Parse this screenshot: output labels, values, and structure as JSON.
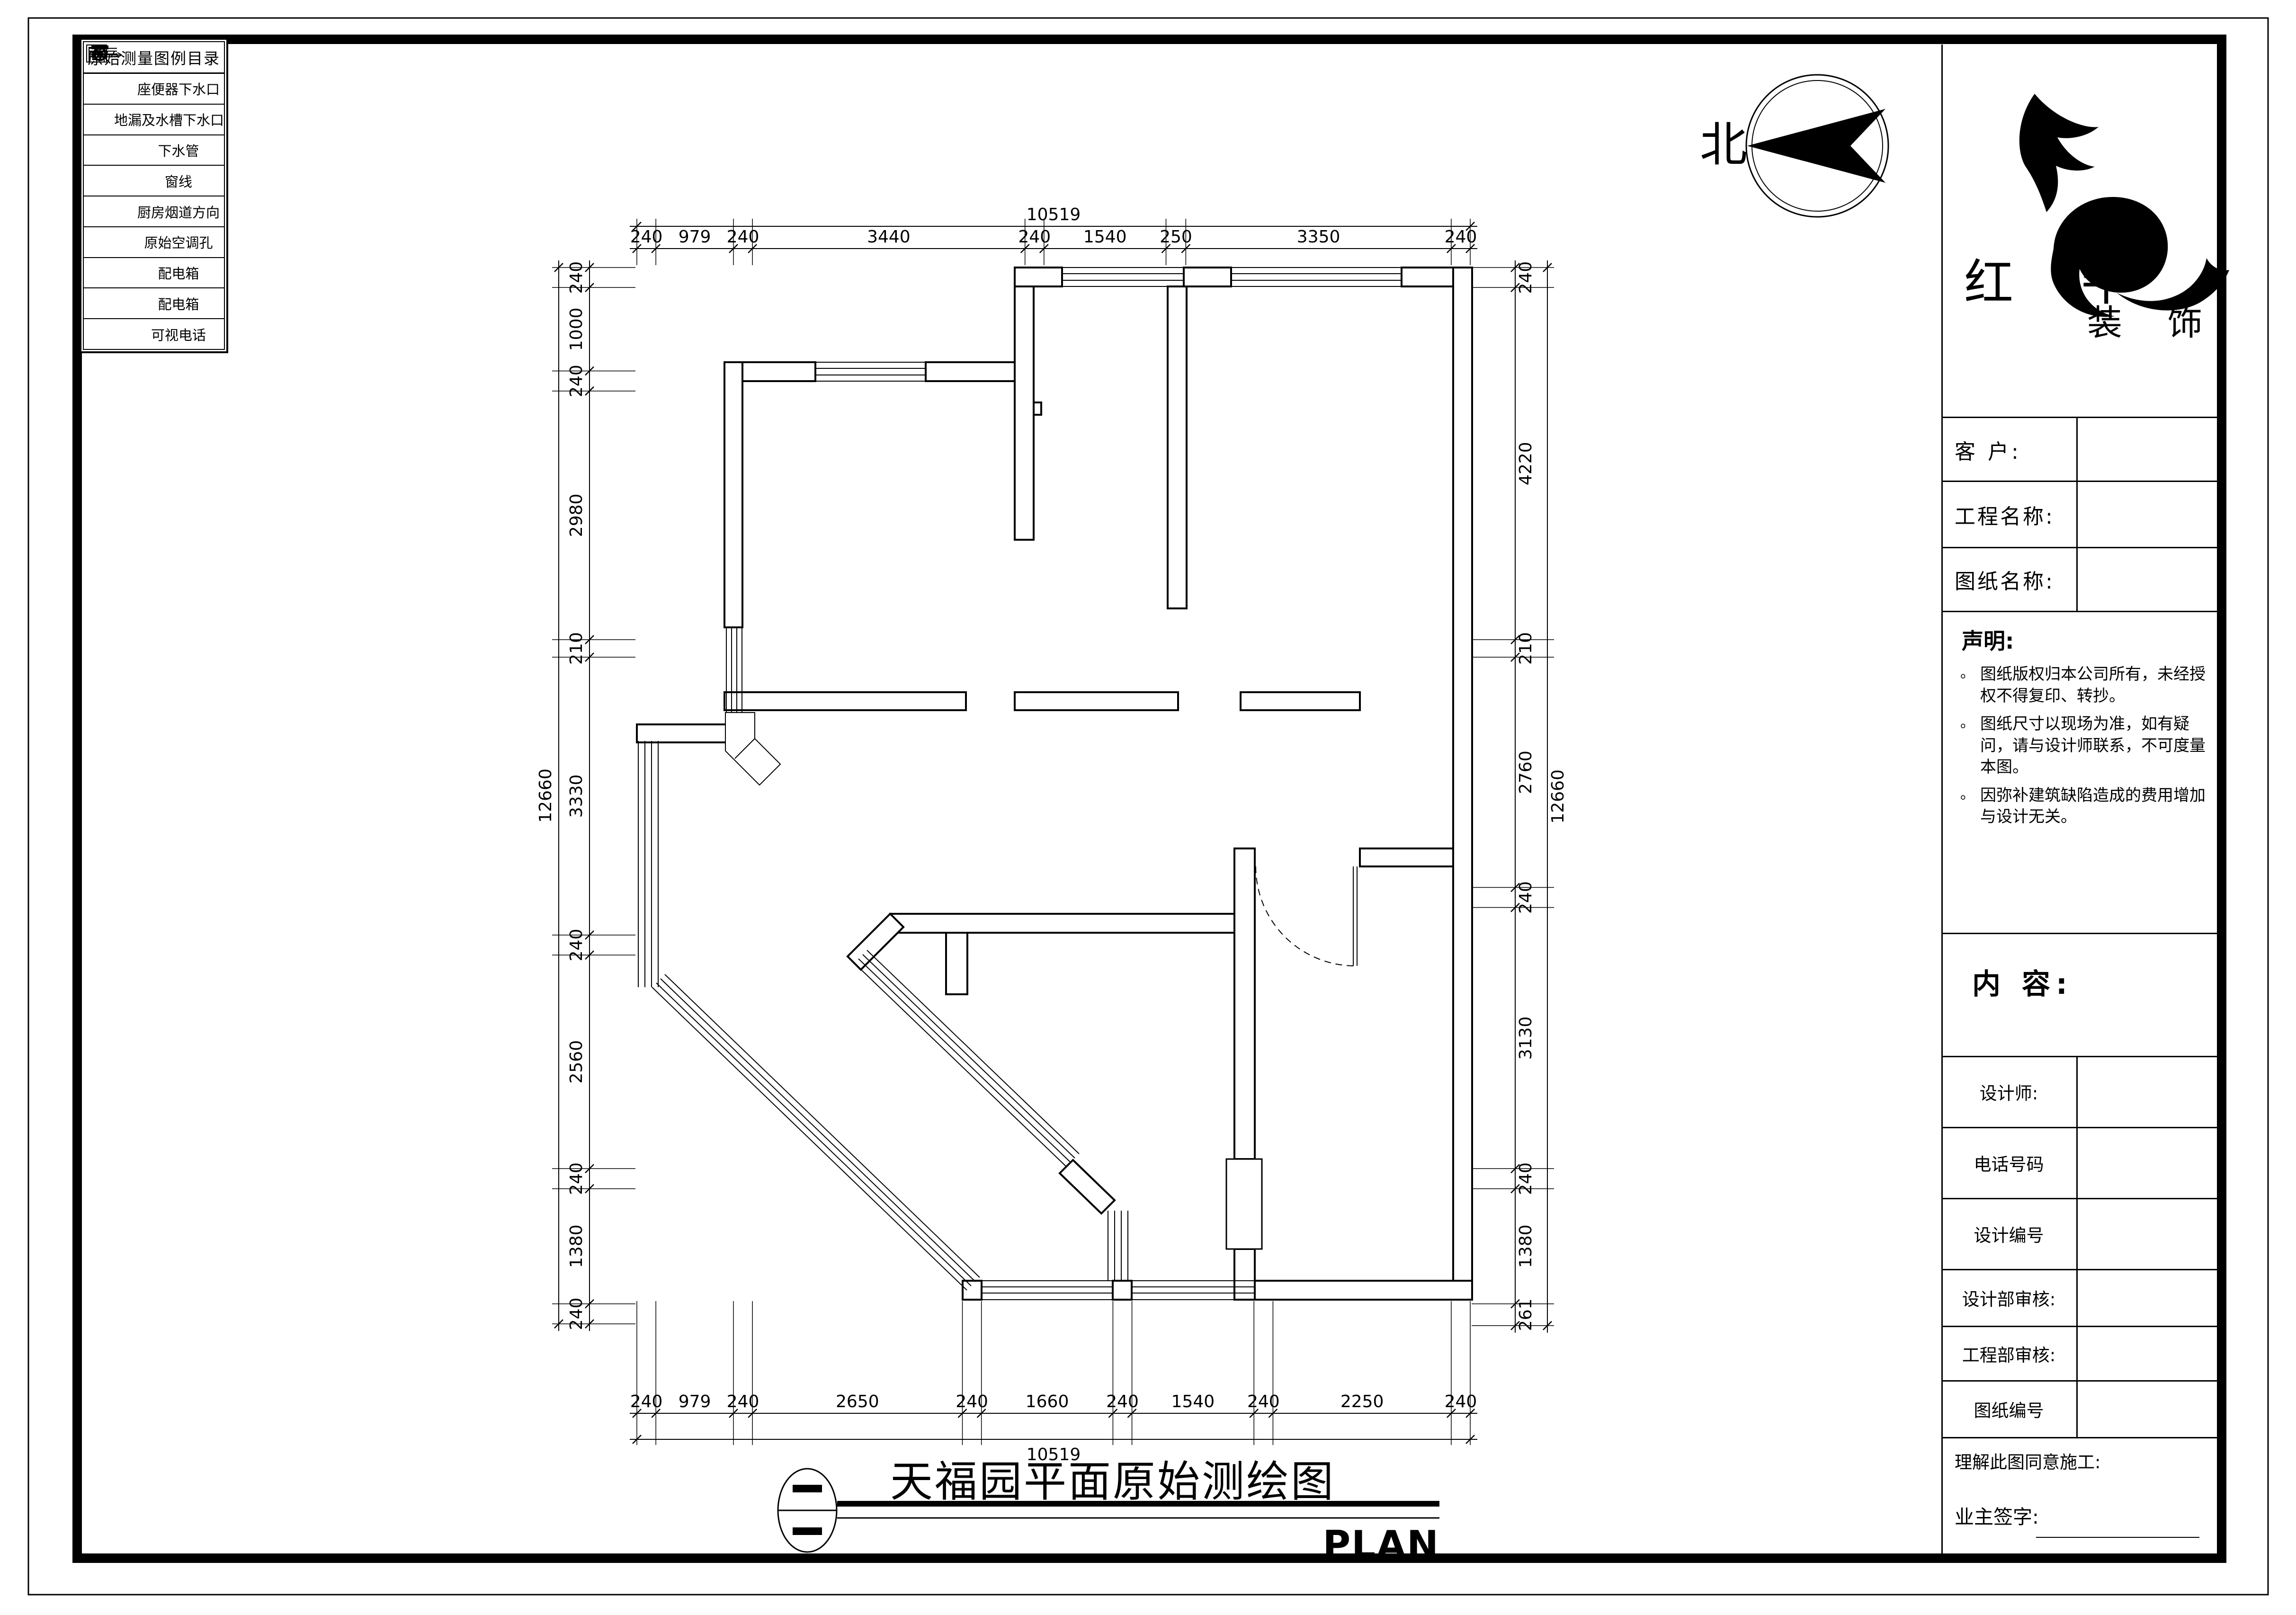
{
  "colors": {
    "ink": "#000000",
    "paper": "#ffffff"
  },
  "legend": {
    "title": "原始测量图例目录",
    "items": [
      {
        "icon": "toilet-drain-icon",
        "label": "座便器下水口"
      },
      {
        "icon": "floor-drain-icon",
        "label": "地漏及水槽下水口"
      },
      {
        "icon": "drain-pipe-icon",
        "label": "下水管"
      },
      {
        "icon": "window-line-icon",
        "label": "窗线"
      },
      {
        "icon": "kitchen-flue-icon",
        "label": "厨房烟道方向"
      },
      {
        "icon": "ac-hole-icon",
        "label": "原始空调孔",
        "tag": "K"
      },
      {
        "icon": "dist-box-icon",
        "label": "配电箱",
        "tag": "配"
      },
      {
        "icon": "weak-box-icon",
        "label": "配电箱",
        "tag": "弱"
      },
      {
        "icon": "video-phone-icon",
        "label": "可视电话",
        "tag": "可"
      }
    ]
  },
  "compass": {
    "north_label": "北"
  },
  "title_block": {
    "brand_line1": "红 牛",
    "brand_line2": "装 饰",
    "customer_label": "客  户:",
    "project_label": "工程名称:",
    "drawing_label": "图纸名称:",
    "statement_title": "声明:",
    "statement_items": [
      "图纸版权归本公司所有，未经授权不得复印、转抄。",
      "图纸尺寸以现场为准，如有疑问，请与设计师联系，不可度量本图。",
      "因弥补建筑缺陷造成的费用增加与设计无关。"
    ],
    "content_label": "内 容:",
    "info_rows": [
      "设计师:",
      "电话号码",
      "设计编号",
      "设计部审核:",
      "工程部审核:",
      "图纸编号"
    ],
    "agreement_label": "理解此图同意施工:",
    "owner_sign_label": "业主签字:"
  },
  "footer": {
    "drawing_title": "天福园平面原始测绘图",
    "plan_label": "PLAN"
  },
  "dimensions": {
    "top": {
      "total": "10519",
      "segments": [
        240,
        979,
        240,
        3440,
        240,
        1540,
        250,
        3350,
        240
      ]
    },
    "bottom": {
      "total": "10519",
      "segments": [
        240,
        979,
        240,
        2650,
        240,
        1660,
        240,
        1540,
        240,
        2250,
        240
      ]
    },
    "left": {
      "total": "12660",
      "segments": [
        240,
        1000,
        240,
        2980,
        210,
        3330,
        240,
        2560,
        240,
        1380,
        240
      ]
    },
    "right": {
      "total": "12660",
      "segments": [
        240,
        4220,
        210,
        2760,
        240,
        3130,
        240,
        1380,
        261
      ]
    }
  }
}
